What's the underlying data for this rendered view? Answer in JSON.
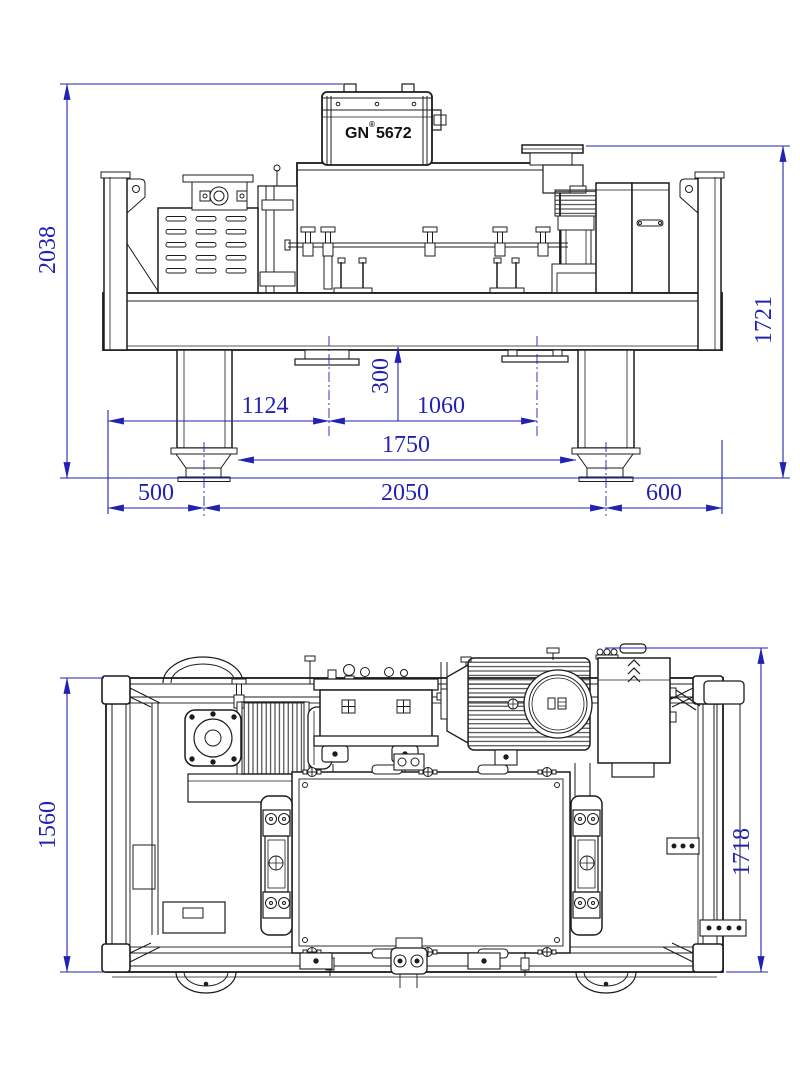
{
  "label": {
    "brand": "GN",
    "registered": "®",
    "model": "5672"
  },
  "front": {
    "dims": {
      "overall_height": "2038",
      "inlet_top_height": "1721",
      "underframe_offset": "300",
      "left_edge_to_solids_outlet": "1124",
      "solids_outlet_to_liquid_outlet": "1060",
      "foot_inner_span": "1750",
      "left_foot_offset": "500",
      "foot_center_span": "2050",
      "right_foot_offset": "600"
    }
  },
  "plan": {
    "dims": {
      "frame_width": "1560",
      "overall_width": "1718"
    }
  },
  "colors": {
    "dimension_blue": "#2222b2",
    "line_black": "#1c1c1c"
  }
}
